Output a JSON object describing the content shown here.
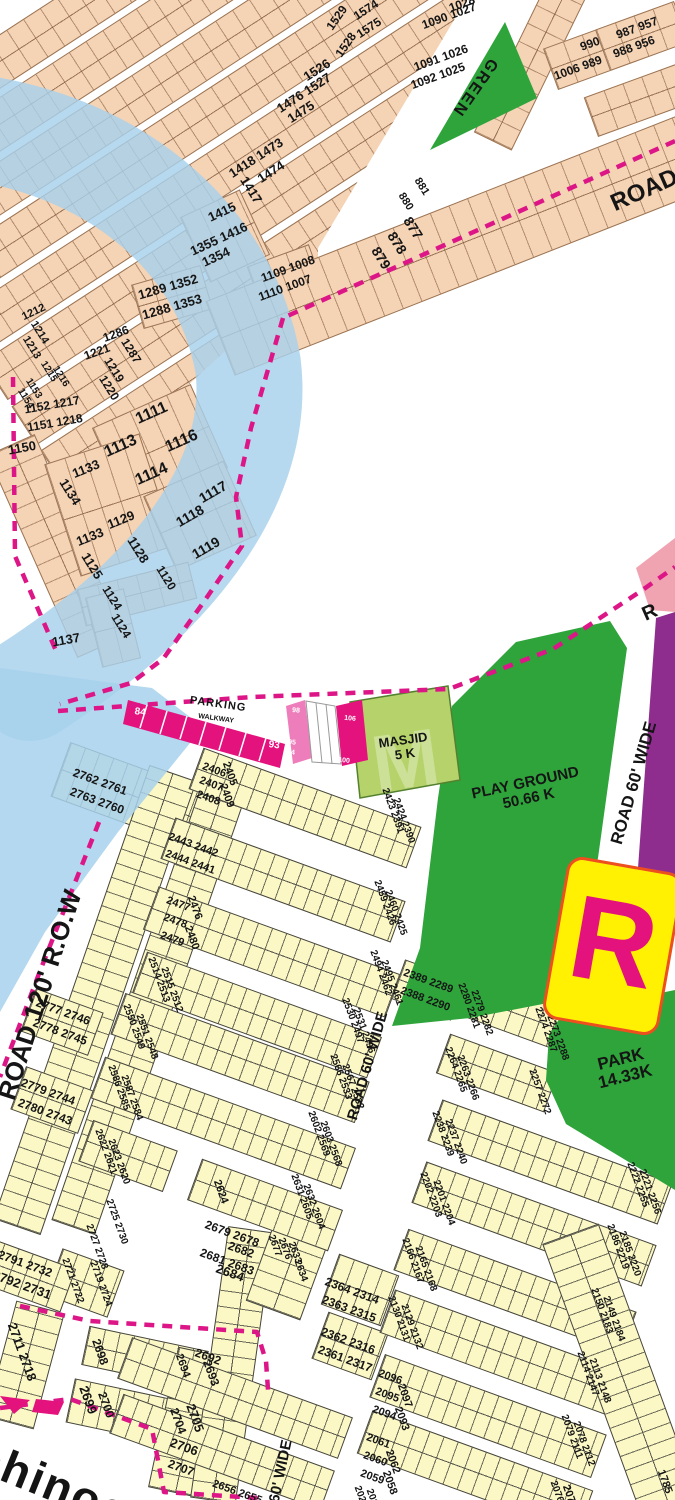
{
  "areas": {
    "green": "GREEN",
    "masjid": "MASJID\n5 K",
    "playground": "PLAY GROUND\n50.66 K",
    "park": "PARK\n14.33K",
    "parking": "PARKING",
    "walkway": "WALKWAY"
  },
  "roads": {
    "top_right": "ROAD",
    "right_fragment": "R",
    "r60_right": "ROAD 60' WIDE",
    "r60_mid": "ROAD 60' WIDE",
    "r60_bottom": "ROAD 60' WIDE",
    "r120": "ROAD 120' R.O.W"
  },
  "marker_r": "R",
  "big_text": "ohinoc",
  "colors": {
    "plot_peach": "#F5D3B5",
    "plot_yellow": "#FBF8C5",
    "amenity_green": "#2EA43B",
    "masjid_green": "#B6D36B",
    "commercial_magenta": "#E4127D",
    "boundary_magenta": "#DD1687",
    "water_blue": "#A7D1EC",
    "purple": "#8F2D8F",
    "pink_plot": "#F0A3B0",
    "sign_yellow": "#FFF101"
  },
  "plots": {
    "n1526": "1526",
    "n1476": "1476 1527",
    "n1475": "1475",
    "n1418": "1418 1473",
    "n1474": "1474",
    "n1417": "1417",
    "n1415": "1415",
    "n1355": "1355 1416",
    "n1354": "1354",
    "n1289": "1289 1352",
    "n1288": "1288 1353",
    "n1109": "1109 1008",
    "n1110": "1110 1007",
    "n1529": "1529",
    "n1574": "1574",
    "n1575": "1575",
    "n1528": "1528",
    "n1028": "1028",
    "n1090": "1090 1027",
    "n1091": "1091 1026",
    "n1092": "1092 1025",
    "n990": "990",
    "n1006": "1006 989",
    "n987": "987 957",
    "n988": "988 956",
    "n881": "881",
    "n880": "880",
    "n877": "877",
    "n878": "878",
    "n879": "879",
    "n1212": "1212",
    "n1214": "1214",
    "n1213": "1213",
    "n1215": "1215",
    "n1216": "1216",
    "n1153": "1153",
    "n1154": "1154",
    "n1152": "1152 1217",
    "n1151": "1151 1218",
    "n1221": "1221",
    "n1286": "1286",
    "n1287": "1287",
    "n1219": "1219",
    "n1220": "1220",
    "n1150": "1150",
    "n1111": "1111",
    "n1116": "1116",
    "n1113": "1113",
    "n1114": "1114",
    "n1133a": "1133",
    "n1134": "1134",
    "n1129": "1129",
    "n1133b": "1133",
    "n1128": "1128",
    "n1125": "1125",
    "n1117": "1117",
    "n1118": "1118",
    "n1119": "1119",
    "n1120": "1120",
    "n1124a": "1124",
    "n1124b": "1124",
    "n1137": "1137",
    "c84": "84",
    "c93": "93",
    "c95": "95",
    "c94": "94",
    "c98": "98",
    "c106": "106",
    "c100": "100",
    "n2762": "2762 2761",
    "n2763": "2763 2760",
    "n2777": "2777 2746",
    "n2778": "2778 2745",
    "n2779": "2779 2744",
    "n2780": "2780 2743",
    "n2725": "2725 2730",
    "n2727": "2727 2728",
    "n2791": "2791 2732",
    "n2792": "2792 2731",
    "n2721": "2721 2722",
    "n2719": "2719 2724",
    "n2711": "2711 2718",
    "n2698": "2698",
    "n2694": "2694",
    "n2692": "2692",
    "n2693": "2693",
    "n2699": "2699",
    "n2700": "2700",
    "n2704": "2704",
    "n2705": "2705",
    "n2706": "2706",
    "n2707": "2707",
    "n2679": "2679 2678",
    "n2682": "2682",
    "n2681": "2681 2683",
    "n2684": "2684",
    "n2656": "2656 2655",
    "n2677": "2677",
    "n2676": "2676",
    "n2633": "2633",
    "n2634": "2634",
    "n2406": "2406",
    "n2405": "2405",
    "n2407": "2407",
    "n2408": "2408",
    "n2409": "2409",
    "n2423": "2423 2391",
    "n2424": "2424 2390",
    "n2443": "2443 2442",
    "n2444": "2444 2441",
    "n2459": "2459 2426",
    "n2460": "2460 2425",
    "n2477": "2477",
    "n2476": "2476",
    "n2478": "2478",
    "n2479": "2479",
    "n2480": "2480",
    "n2494": "2494 2462",
    "n2495": "2495 2461",
    "n2514": "2514 2513",
    "n2515": "2515 2512",
    "n2530": "2530 2497",
    "n2531": "2531 2496",
    "n2550": "2550 2549",
    "n2551": "2551 2548",
    "n2586": "2586 2585",
    "n2587": "2587 2584",
    "n2566": "2566 2533",
    "n2567": "2567 2532",
    "n2602": "2602 2569",
    "n2603": "2603 2568",
    "n2622": "2622 2621",
    "n2623": "2623 2620",
    "n2624": "2624",
    "n2631": "2631 2605",
    "n2632": "2632 2604",
    "n2389": "2389 2289",
    "n2388": "2388 2290",
    "n2280": "2280 2281",
    "n2279": "2279 2282",
    "n2274": "2274 2287",
    "n2273": "2273 2288",
    "n2264": "2264 2265",
    "n2263": "2263 2266",
    "n2257": "2257 2272",
    "n2238": "2238 2239",
    "n2237": "2237 2240",
    "n2222": "2222 2255",
    "n2221": "2221 2256",
    "n2202": "2202 2203",
    "n2201": "2201 2204",
    "n2186": "2186 2219",
    "n2185": "2185 2220",
    "n2166": "2166 2167",
    "n2165": "2165 2168",
    "n2150": "2150 2183",
    "n2149": "2149 2184",
    "n2130": "2130 2131",
    "n2129": "2129 2132",
    "n2114": "2114 2147",
    "n2113": "2113 2148",
    "n2096": "2096",
    "n2095": "2095",
    "n2094": "2094",
    "n2097": "2097",
    "n2093": "2093",
    "n2079": "2079 2111",
    "n2078": "2078 2112",
    "n2061": "2061",
    "n2060": "2060",
    "n2059": "2059",
    "n2062": "2062",
    "n2058": "2058",
    "n2076": "2076",
    "n2077": "2077",
    "n2026": "2026",
    "n2027": "2027",
    "n2364": "2364 2314",
    "n2363": "2363 2315",
    "n2362": "2362 2316",
    "n2361": "2361 2317",
    "n1785": "1785"
  }
}
